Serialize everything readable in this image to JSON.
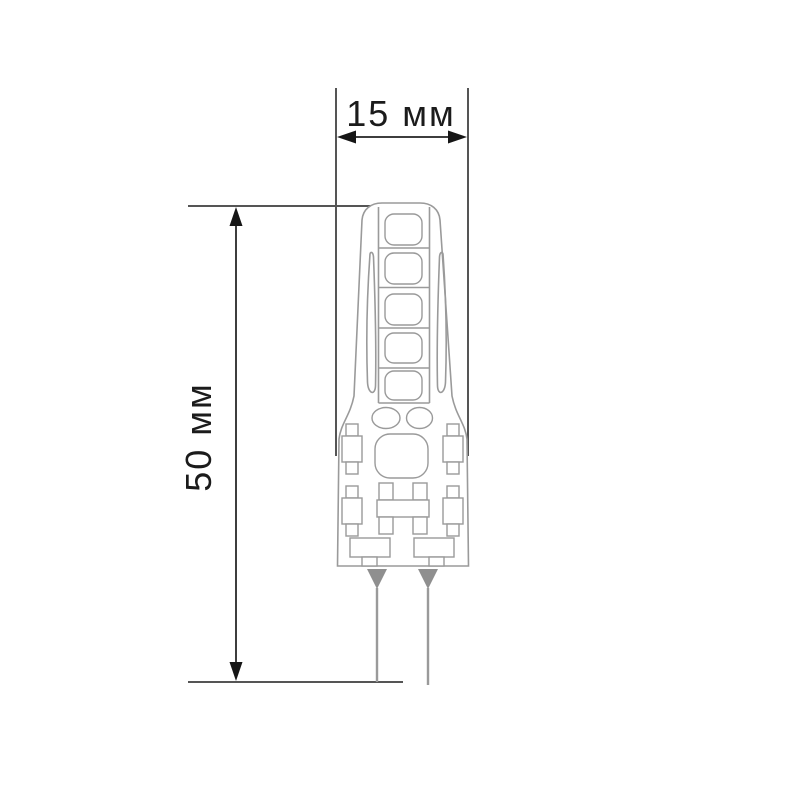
{
  "page": {
    "background": "#ffffff"
  },
  "drawing": {
    "type": "technical-dimension-drawing",
    "labels": {
      "width": "15 мм",
      "height": "50 мм"
    },
    "lamp": {
      "led_count": 5,
      "pin_count": 2,
      "side_resistor_count": 4,
      "capacitor_ellipse_count": 2
    },
    "colors": {
      "label_text": "#1b1b1b",
      "dimension_line": "#3e3e3e",
      "extension_line": "#555555",
      "arrowhead": "#161616",
      "lamp_outline": "#9a9a9a",
      "pin_fill": "#8f8f8f",
      "background": "#ffffff"
    }
  }
}
